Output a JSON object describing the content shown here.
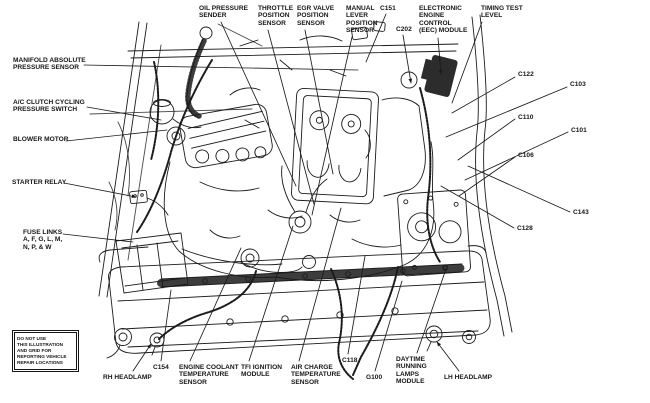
{
  "style": {
    "ink": "#1b1b1b",
    "paper": "#ffffff"
  },
  "warning_box": {
    "lines": [
      "DO NOT USE",
      "THIS ILLUSTRATION",
      "AND GRID FOR",
      "REPORTING VEHICLE",
      "REPAIR LOCATIONS"
    ]
  },
  "callouts": [
    {
      "name": "manifold-absolute-pressure-sensor",
      "lines": [
        "MANIFOLD ABSOLUTE",
        "PRESSURE SENSOR"
      ],
      "x": 13,
      "y": 57,
      "leader": [
        84,
        65,
        358,
        70
      ],
      "arrow": false
    },
    {
      "name": "oil-pressure-sender",
      "lines": [
        "OIL PRESSURE",
        "SENDER"
      ],
      "x": 199,
      "y": 5,
      "leader": [
        221,
        22,
        296,
        186
      ],
      "arrow": false
    },
    {
      "name": "throttle-position-sensor",
      "lines": [
        "THROTTLE",
        "POSITION",
        "SENSOR"
      ],
      "x": 258,
      "y": 5,
      "leader": [
        268,
        30,
        314,
        204
      ],
      "arrow": false
    },
    {
      "name": "egr-valve-position-sensor",
      "lines": [
        "EGR VALVE",
        "POSITION",
        "SENSOR"
      ],
      "x": 297,
      "y": 5,
      "leader": [
        305,
        30,
        333,
        174
      ],
      "arrow": false
    },
    {
      "name": "manual-lever-position-sensor",
      "lines": [
        "MANUAL",
        "LEVER",
        "POSITION",
        "SENSOR"
      ],
      "x": 346,
      "y": 5,
      "leader": [
        352,
        37,
        312,
        215
      ],
      "arrow": false
    },
    {
      "name": "c151",
      "lines": [
        "C151"
      ],
      "x": 380,
      "y": 5,
      "leader": [
        386,
        14,
        366,
        62
      ],
      "arrow": false
    },
    {
      "name": "c202",
      "lines": [
        "C202"
      ],
      "x": 396,
      "y": 26,
      "leader": [
        403,
        35,
        411,
        83
      ],
      "arrow": true
    },
    {
      "name": "electronic-engine-control-eec-module",
      "lines": [
        "ELECTRONIC",
        "ENGINE",
        "CONTROL",
        "(EEC) MODULE"
      ],
      "x": 419,
      "y": 5,
      "leader": [
        438,
        38,
        441,
        74
      ],
      "arrow": true
    },
    {
      "name": "timing-test-level",
      "lines": [
        "TIMING TEST",
        "LEVEL"
      ],
      "x": 481,
      "y": 5,
      "leader": [
        482,
        22,
        452,
        103
      ],
      "arrow": false
    },
    {
      "name": "c122",
      "lines": [
        "C122"
      ],
      "x": 518,
      "y": 71,
      "leader": [
        515,
        77,
        452,
        113
      ],
      "arrow": false
    },
    {
      "name": "c103",
      "lines": [
        "C103"
      ],
      "x": 570,
      "y": 81,
      "leader": [
        567,
        87,
        446,
        137
      ],
      "arrow": false
    },
    {
      "name": "c110",
      "lines": [
        "C110"
      ],
      "x": 518,
      "y": 114,
      "leader": [
        515,
        119,
        458,
        160
      ],
      "arrow": false
    },
    {
      "name": "c101",
      "lines": [
        "C101"
      ],
      "x": 571,
      "y": 127,
      "leader": [
        568,
        132,
        465,
        180
      ],
      "arrow": false
    },
    {
      "name": "c106",
      "lines": [
        "C106"
      ],
      "x": 518,
      "y": 152,
      "leader": [
        515,
        157,
        459,
        196
      ],
      "arrow": false
    },
    {
      "name": "c143",
      "lines": [
        "C143"
      ],
      "x": 573,
      "y": 209,
      "leader": [
        570,
        212,
        468,
        166
      ],
      "arrow": false
    },
    {
      "name": "c128",
      "lines": [
        "C128"
      ],
      "x": 517,
      "y": 225,
      "leader": [
        514,
        228,
        441,
        186
      ],
      "arrow": false
    },
    {
      "name": "ac-clutch-cycling-pressure-switch",
      "lines": [
        "A/C CLUTCH CYCLING",
        "PRESSURE SWITCH"
      ],
      "x": 13,
      "y": 99,
      "leader": [
        87,
        107,
        161,
        120
      ],
      "arrow": false
    },
    {
      "name": "blower-motor",
      "lines": [
        "BLOWER MOTOR"
      ],
      "x": 13,
      "y": 136,
      "leader": [
        66,
        141,
        167,
        130
      ],
      "arrow": false
    },
    {
      "name": "starter-relay",
      "lines": [
        "STARTER RELAY"
      ],
      "x": 12,
      "y": 179,
      "leader": [
        64,
        183,
        136,
        197
      ],
      "arrow": true
    },
    {
      "name": "fuse-links",
      "lines": [
        "FUSE LINKS",
        "A, F, G, L, M,",
        "N, P, & W"
      ],
      "x": 23,
      "y": 229,
      "leader": [
        63,
        234,
        133,
        242
      ],
      "arrow": false
    },
    {
      "name": "rh-headlamp",
      "lines": [
        "RH HEADLAMP"
      ],
      "x": 103,
      "y": 374,
      "leader": [
        133,
        371,
        151,
        344
      ],
      "arrow": true
    },
    {
      "name": "c154",
      "lines": [
        "C154"
      ],
      "x": 153,
      "y": 364,
      "leader": [
        161,
        361,
        171,
        290
      ],
      "arrow": false
    },
    {
      "name": "engine-coolant-temperature-sensor",
      "lines": [
        "ENGINE COOLANT",
        "TEMPERATURE",
        "SENSOR"
      ],
      "x": 179,
      "y": 364,
      "leader": [
        190,
        361,
        241,
        248
      ],
      "arrow": false
    },
    {
      "name": "tfi-ignition-module",
      "lines": [
        "TFI IGNITION",
        "MODULE"
      ],
      "x": 241,
      "y": 364,
      "leader": [
        249,
        361,
        293,
        226
      ],
      "arrow": false
    },
    {
      "name": "air-charge-temperature-sensor",
      "lines": [
        "AIR CHARGE",
        "TEMPERATURE",
        "SENSOR"
      ],
      "x": 291,
      "y": 364,
      "leader": [
        299,
        361,
        341,
        208
      ],
      "arrow": false
    },
    {
      "name": "c118",
      "lines": [
        "C118"
      ],
      "x": 342,
      "y": 357,
      "leader": [
        348,
        354,
        365,
        256
      ],
      "arrow": false
    },
    {
      "name": "g100",
      "lines": [
        "G100"
      ],
      "x": 366,
      "y": 374,
      "leader": [
        375,
        371,
        402,
        281
      ],
      "arrow": false
    },
    {
      "name": "daytime-running-lamps-module",
      "lines": [
        "DAYTIME",
        "RUNNING",
        "LAMPS",
        "MODULE"
      ],
      "x": 396,
      "y": 356,
      "leader": [
        417,
        353,
        446,
        269
      ],
      "arrow": false
    },
    {
      "name": "lh-headlamp",
      "lines": [
        "LH HEADLAMP"
      ],
      "x": 444,
      "y": 374,
      "leader": [
        459,
        371,
        437,
        342
      ],
      "arrow": true
    }
  ]
}
